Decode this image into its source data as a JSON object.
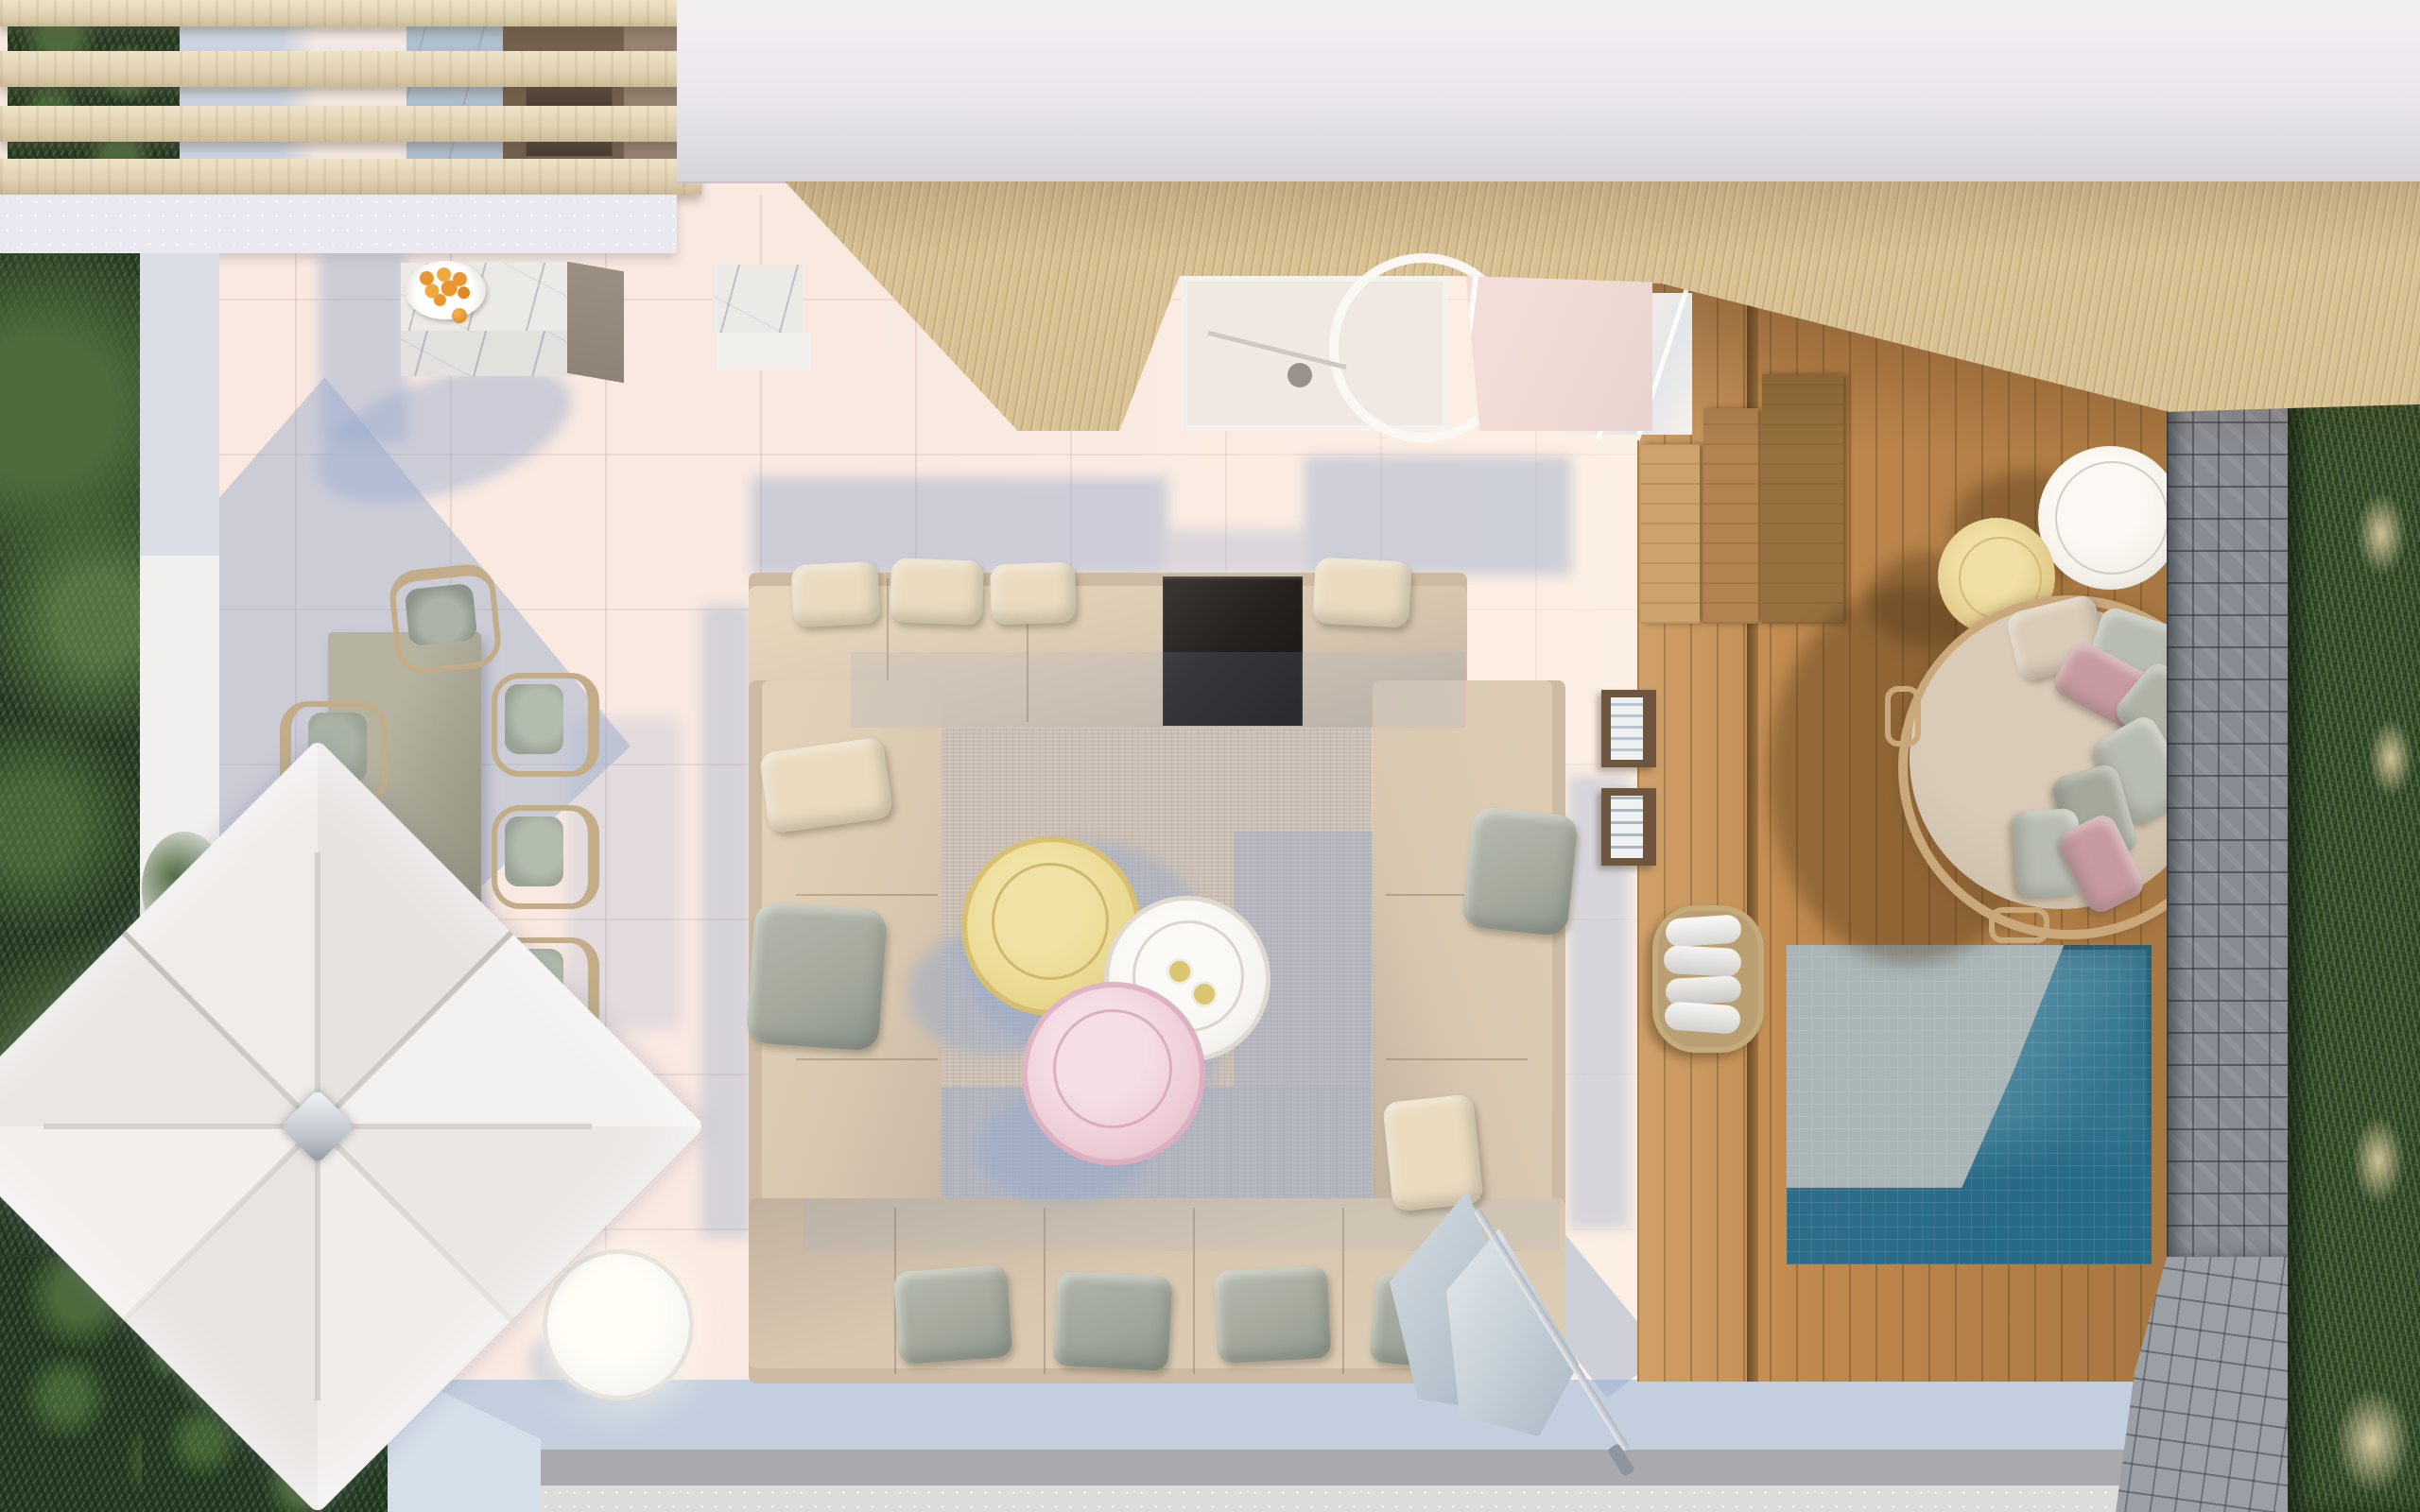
{
  "meta": {
    "type": "3d-architectural-render",
    "view": "top-down aerial plan view",
    "subject": "luxury terrace with outdoor lounge, dining area, cantilever parasol, timber deck, plunge pool, daybed, stone wall and ornamental planting",
    "render_size": "2560x1600"
  },
  "colors": {
    "floor_tile": "#f9e9e1",
    "floor_tile_lit": "#fef2e8",
    "band_speckle": "#eae8f0",
    "roof_slab": "#e9e5ec",
    "roof_slab_dark": "#d8d4dc",
    "slat_wood": "#e0d2b2",
    "slat_wood_dark": "#cdbb97",
    "soffit_wood": "#d8c193",
    "deck_wood": "#c08a4e",
    "deck_groove": "#6e4a24",
    "bench_a": "#cda26c",
    "bench_b": "#b08350",
    "bench_c": "#96713f",
    "stone_base": "#878c92",
    "stone_light": "#9aa0a5",
    "grass_base": "#34482d",
    "hedge_dark": "#2c3f2a",
    "hedge_light": "#4e6b3c",
    "grass_plume": "#cfc296",
    "pool_reflection": "#a9b5b6",
    "pool_mid": "#5d93a8",
    "pool_deep": "#2e6d89",
    "marble": "#eceae7",
    "backsplash_blue": "#aebfd0",
    "cabinet_dark": "#73604d",
    "appliance_dark": "#4a3d32",
    "cabinet_tan": "#978271",
    "island_side": "#8e8376",
    "sofa_seat": "#d9c8b1",
    "sofa_back": "#cdbaa2",
    "console_dark": "#262220",
    "pillow_cream": "#eadbc0",
    "pillow_sage": "#a3a89b",
    "pillow_pink": "#c79aa0",
    "pillow_grey": "#b8bdb2",
    "rug_base": "#cabdb1",
    "table_yellow": "#e9d88f",
    "table_yellow_inner": "#f0e2a4",
    "table_white": "#f5f4f0",
    "table_pink": "#edccd6",
    "table_pink_inner": "#f5dee6",
    "dining_table": "#a8a593",
    "dining_chair_seat": "#99a094",
    "dining_chair_frame": "#c3ad88",
    "umbrella_canopy": "#efecea",
    "umbrella_metal": "#c9ccd2",
    "daybed_frame": "#c9a87c",
    "daybed_cushion": "#cfc0ab",
    "pouf_white": "#f3efe9",
    "pouf_yellow": "#e3cd8d",
    "towel_white": "#f2f1ee",
    "basket_tan": "#c4ab7c",
    "shrub_dark": "#273c26",
    "planter_wall": "#d5dfe9",
    "wall_white": "#f2f0ee",
    "path_grey": "#aaa9ae",
    "path_light": "#dedbdb",
    "band_blue": "#c3cfdf",
    "glass_pink": "#f3ddd8",
    "interior_warm": "#efe8e3",
    "orange_fruit": "#e8962e",
    "shadow_blue": "rgba(148,168,205,0.45)",
    "shadow_warm": "rgba(70,45,20,0.35)"
  },
  "scene": {
    "objects": [
      {
        "name": "pergola-slats",
        "count": 4,
        "note": "light timber beams, top-left"
      },
      {
        "name": "hedge-left",
        "note": "tropical planting along left edge"
      },
      {
        "name": "outdoor-kitchen",
        "note": "marble island with bowl of oranges, marble column, interior cabinetry with appliances"
      },
      {
        "name": "roof-slab",
        "note": "white concrete roof band along top"
      },
      {
        "name": "timber-ceiling",
        "note": "diagonal-grain soffit over top-centre and right"
      },
      {
        "name": "bathroom-skylight",
        "note": "glazed opening with shower room visible"
      },
      {
        "name": "dining-set",
        "note": "rectangular table with six chairs"
      },
      {
        "name": "cantilever-parasol",
        "note": "large square white canopy with centre hub and side arm"
      },
      {
        "name": "sectional-sofa",
        "note": "U-shaped beige modular sofa with cream and sage pillows and black console insert"
      },
      {
        "name": "area-rug",
        "note": "woven beige rug with blue cast shadows"
      },
      {
        "name": "coffee-tables",
        "items": [
          "yellow round",
          "white round with two glasses",
          "pink round"
        ]
      },
      {
        "name": "side-table-white",
        "note": "glowing round table, lower left of sofa"
      },
      {
        "name": "folded-parasol",
        "note": "closed umbrella leaning at sofa lower right"
      },
      {
        "name": "timber-deck",
        "note": "vertical planks with bench steps, book ledges, towel basket"
      },
      {
        "name": "plunge-pool",
        "note": "square tiled pool, pale sky reflection and deep teal water"
      },
      {
        "name": "daybed-round",
        "note": "circular daybed ringed with grey and blush pillows"
      },
      {
        "name": "poufs",
        "items": [
          "white pouf",
          "yellow pouf"
        ]
      },
      {
        "name": "stone-wall",
        "note": "grey cobble wall and paving, bottom right"
      },
      {
        "name": "ornamental-grass",
        "note": "tall grasses with wheat plumes along right edge"
      },
      {
        "name": "planter-shrubs",
        "note": "dark shrubs and pale blue planter wall, bottom left"
      }
    ]
  }
}
